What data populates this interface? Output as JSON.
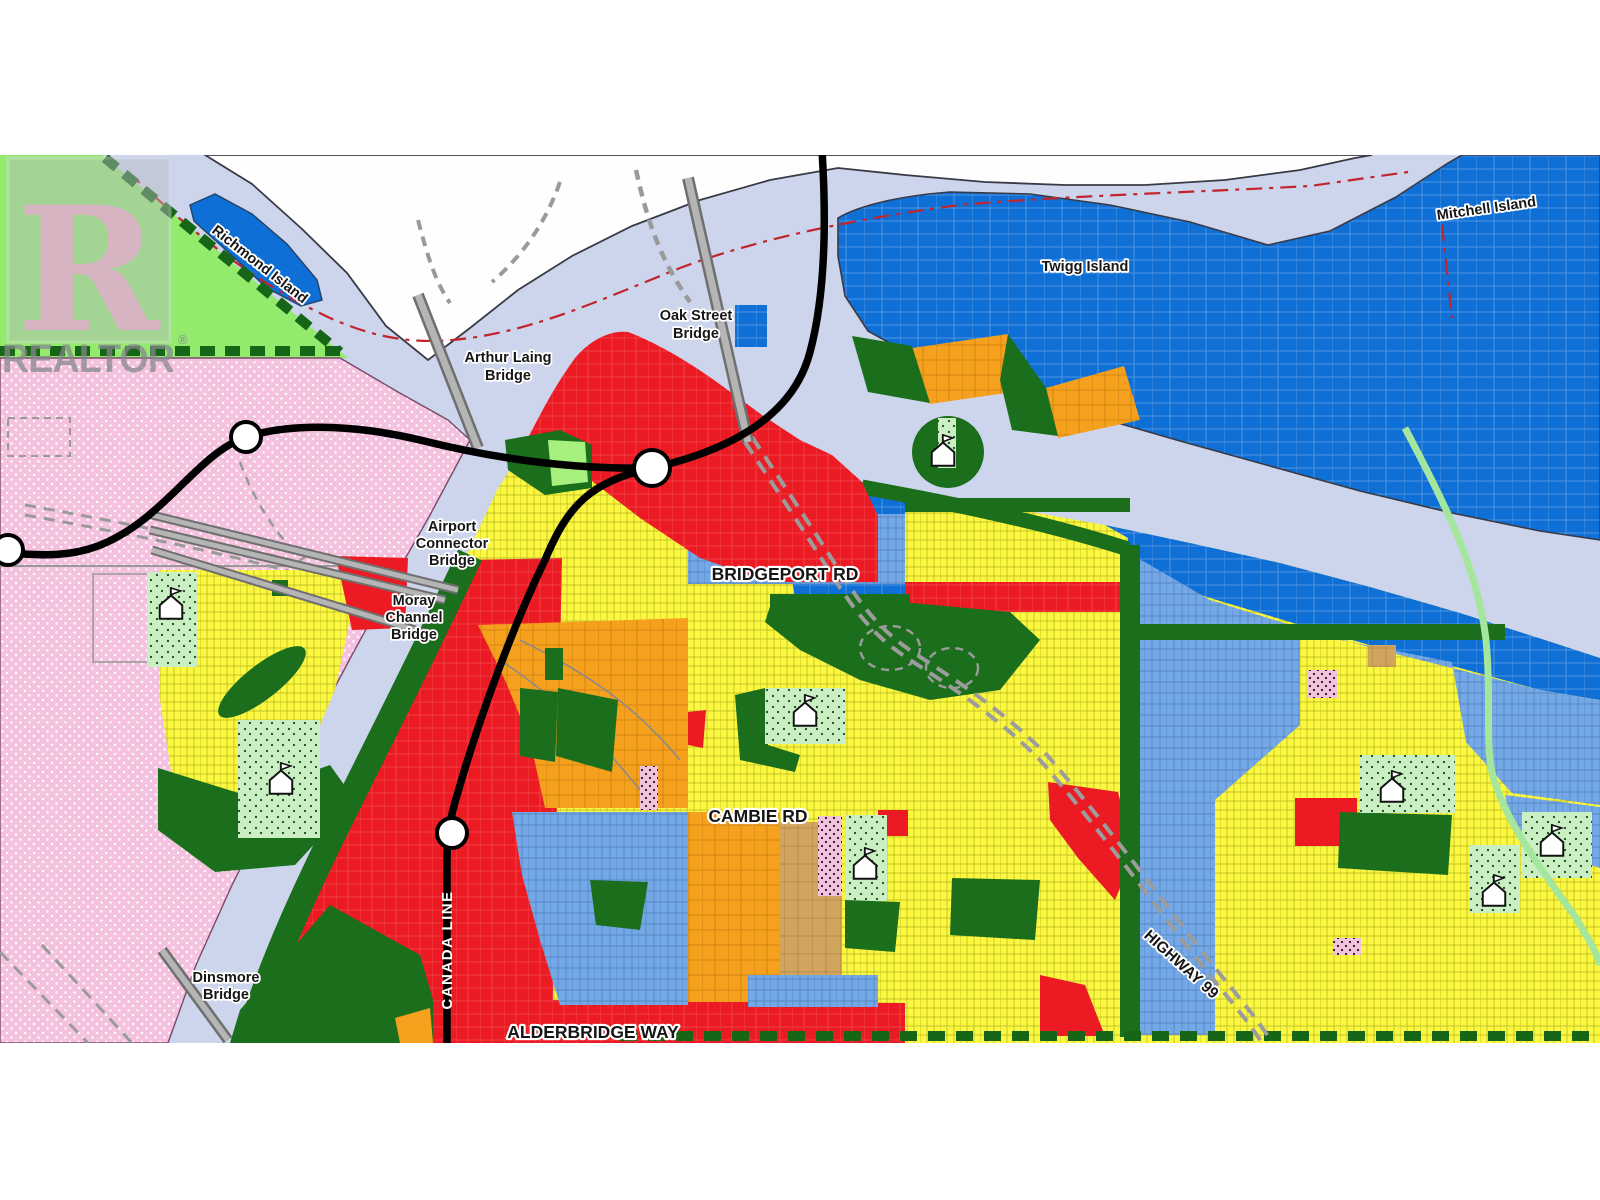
{
  "watermark": {
    "letter": "R",
    "brand": "REALTOR",
    "registered": "®"
  },
  "islands": {
    "richmond": "Richmond Island",
    "twigg": "Twigg Island",
    "mitchell": "Mitchell Island"
  },
  "bridges": {
    "oak_l1": "Oak Street",
    "oak_l2": "Bridge",
    "arthur_l1": "Arthur Laing",
    "arthur_l2": "Bridge",
    "connector_l1": "Airport",
    "connector_l2": "Connector",
    "connector_l3": "Bridge",
    "moray_l1": "Moray",
    "moray_l2": "Channel",
    "moray_l3": "Bridge",
    "dinsmore_l1": "Dinsmore",
    "dinsmore_l2": "Bridge"
  },
  "roads": {
    "bridgeport": "BRIDGEPORT RD",
    "cambie": "CAMBIE RD",
    "alderbridge": "ALDERBRIDGE WAY",
    "highway99": "HIGHWAY 99"
  },
  "transit": {
    "line_label": "CANADA LINE",
    "station_count": 4
  },
  "icons": {
    "school": "house-with-flag",
    "station": "white-circle"
  },
  "colors": {
    "water": "#CCD5EC",
    "shoreline": "#3A3A46",
    "land_white": "#FEFEFE",
    "island_blue": "#0E6FD6",
    "island_street": "#6FA4E4",
    "med_blue": "#74A8E6",
    "med_blue_line": "#2E6CB0",
    "zone_yellow": "#FBF83F",
    "yellow_line": "#7D7D08",
    "zone_red": "#EC1B23",
    "zone_orange": "#F5A11D",
    "zone_tan": "#D2A55E",
    "dark_green": "#1B6E1B",
    "bright_green": "#93EA6D",
    "lt_green": "#A8F07E",
    "lt_green_dots": "#C9EFC3",
    "pink_airport": "#F4C2DF",
    "trail_green": "#176617",
    "transit_black": "#000000",
    "bridge_gray": "#B5B5B5",
    "bridge_edge": "#6F6F6F",
    "hwy_gray": "#9C9C9C",
    "boundary_red": "#C2242C",
    "creek_green": "#A5E69E",
    "label": "#161616"
  }
}
